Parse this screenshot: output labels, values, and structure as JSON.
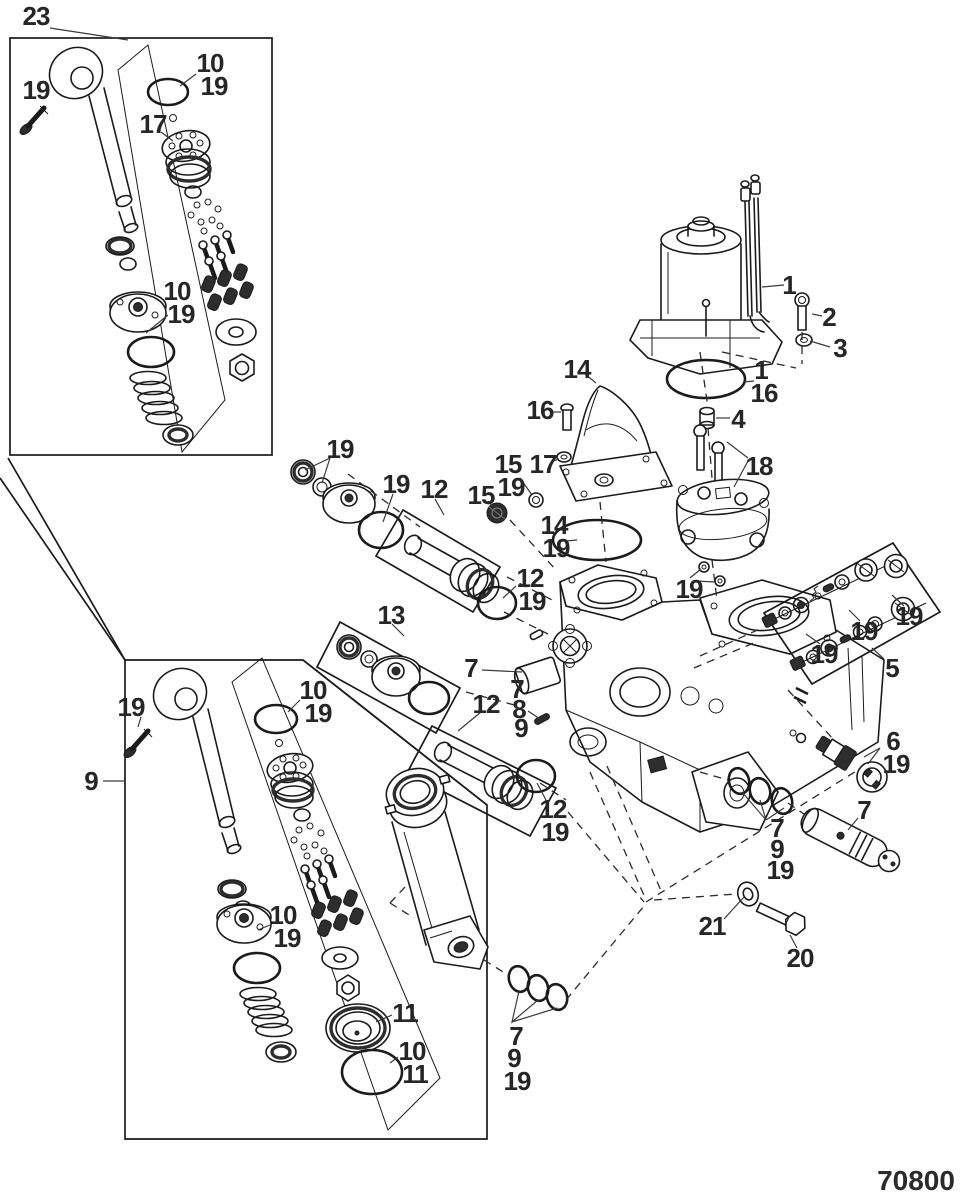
{
  "drawing": {
    "number": "70800"
  },
  "colors": {
    "line": "#1b1b1b",
    "label": "#262626",
    "dark_fill": "#2d2d2d",
    "background": "#ffffff"
  },
  "callouts": [
    {
      "text": "23",
      "x": 36,
      "y": 16
    },
    {
      "text": "19",
      "x": 36,
      "y": 90
    },
    {
      "text": "10",
      "x": 210,
      "y": 63
    },
    {
      "text": "19",
      "x": 214,
      "y": 86
    },
    {
      "text": "17",
      "x": 153,
      "y": 124
    },
    {
      "text": "10",
      "x": 177,
      "y": 291
    },
    {
      "text": "19",
      "x": 181,
      "y": 314
    },
    {
      "text": "1",
      "x": 789,
      "y": 285
    },
    {
      "text": "2",
      "x": 829,
      "y": 317
    },
    {
      "text": "3",
      "x": 840,
      "y": 348
    },
    {
      "text": "1",
      "x": 761,
      "y": 370
    },
    {
      "text": "16",
      "x": 764,
      "y": 393
    },
    {
      "text": "4",
      "x": 738,
      "y": 419
    },
    {
      "text": "16",
      "x": 540,
      "y": 410
    },
    {
      "text": "17",
      "x": 543,
      "y": 464
    },
    {
      "text": "14",
      "x": 577,
      "y": 369
    },
    {
      "text": "15",
      "x": 508,
      "y": 464
    },
    {
      "text": "19",
      "x": 511,
      "y": 487
    },
    {
      "text": "15",
      "x": 481,
      "y": 495
    },
    {
      "text": "14",
      "x": 554,
      "y": 525
    },
    {
      "text": "19",
      "x": 556,
      "y": 548
    },
    {
      "text": "18",
      "x": 759,
      "y": 466
    },
    {
      "text": "19",
      "x": 689,
      "y": 589
    },
    {
      "text": "19",
      "x": 824,
      "y": 654
    },
    {
      "text": "19",
      "x": 864,
      "y": 631
    },
    {
      "text": "19",
      "x": 909,
      "y": 616
    },
    {
      "text": "5",
      "x": 892,
      "y": 668
    },
    {
      "text": "19",
      "x": 340,
      "y": 449
    },
    {
      "text": "19",
      "x": 396,
      "y": 484
    },
    {
      "text": "12",
      "x": 434,
      "y": 489
    },
    {
      "text": "12",
      "x": 530,
      "y": 578
    },
    {
      "text": "19",
      "x": 532,
      "y": 601
    },
    {
      "text": "13",
      "x": 391,
      "y": 615
    },
    {
      "text": "7",
      "x": 471,
      "y": 668
    },
    {
      "text": "7",
      "x": 517,
      "y": 689
    },
    {
      "text": "8",
      "x": 519,
      "y": 709
    },
    {
      "text": "9",
      "x": 521,
      "y": 728
    },
    {
      "text": "12",
      "x": 486,
      "y": 704
    },
    {
      "text": "12",
      "x": 553,
      "y": 809
    },
    {
      "text": "19",
      "x": 555,
      "y": 832
    },
    {
      "text": "6",
      "x": 893,
      "y": 741
    },
    {
      "text": "19",
      "x": 896,
      "y": 764
    },
    {
      "text": "7",
      "x": 864,
      "y": 810
    },
    {
      "text": "7",
      "x": 777,
      "y": 828
    },
    {
      "text": "9",
      "x": 777,
      "y": 849
    },
    {
      "text": "19",
      "x": 780,
      "y": 870
    },
    {
      "text": "21",
      "x": 712,
      "y": 926
    },
    {
      "text": "20",
      "x": 800,
      "y": 958
    },
    {
      "text": "7",
      "x": 516,
      "y": 1036
    },
    {
      "text": "9",
      "x": 514,
      "y": 1058
    },
    {
      "text": "19",
      "x": 517,
      "y": 1081
    },
    {
      "text": "9",
      "x": 91,
      "y": 781
    },
    {
      "text": "19",
      "x": 131,
      "y": 707
    },
    {
      "text": "10",
      "x": 313,
      "y": 690
    },
    {
      "text": "19",
      "x": 318,
      "y": 713
    },
    {
      "text": "10",
      "x": 283,
      "y": 915
    },
    {
      "text": "19",
      "x": 287,
      "y": 938
    },
    {
      "text": "11",
      "x": 405,
      "y": 1013
    },
    {
      "text": "10",
      "x": 412,
      "y": 1051
    },
    {
      "text": "11",
      "x": 415,
      "y": 1074
    }
  ]
}
